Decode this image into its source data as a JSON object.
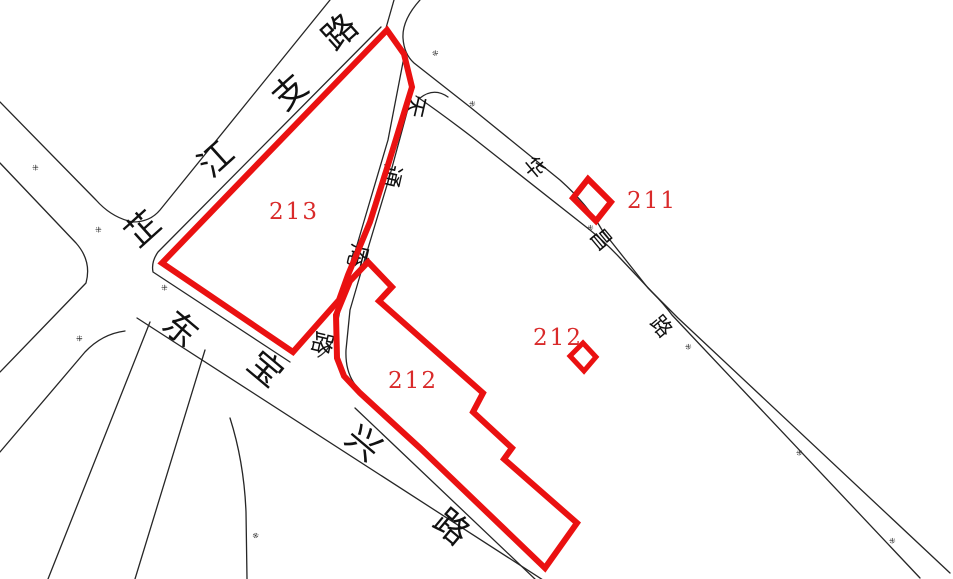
{
  "map": {
    "background_color": "#ffffff",
    "road_line_color": "#262626",
    "parcel_outline_color": "#ea1111",
    "parcel_label_color": "#d92a2a"
  },
  "parcels": [
    {
      "id": "213",
      "label": "213"
    },
    {
      "id": "212",
      "label": "212"
    },
    {
      "id": "212-small",
      "label": "212"
    },
    {
      "id": "211",
      "label": "211"
    }
  ],
  "roads": [
    {
      "id": "zhijiang-branch-road",
      "name": "芷江支路",
      "chars": [
        "芷",
        "江",
        "支",
        "路"
      ]
    },
    {
      "id": "dongbaoxing-road",
      "name": "东宝兴路",
      "chars": [
        "东",
        "宝",
        "兴",
        "路"
      ]
    },
    {
      "id": "tiantongan-road",
      "name": "天通庵路",
      "chars": [
        "天",
        "通",
        "庵",
        "路"
      ]
    },
    {
      "id": "huachang-road",
      "name": "华昌路",
      "chars": [
        "华",
        "昌",
        "路"
      ]
    }
  ],
  "tiny_mark_glyph": "※"
}
